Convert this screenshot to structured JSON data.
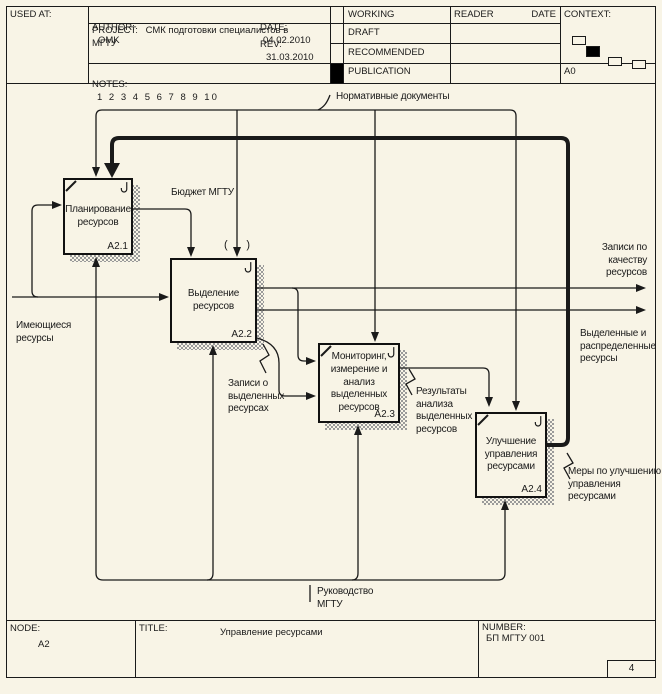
{
  "header": {
    "used_at": "USED AT:",
    "author_label": "AUTHOR:",
    "author_value": "OMK",
    "project_label": "PROJECT:",
    "project_value": "СМК подготовки специалистов в МГТУ",
    "notes_label": "NOTES:",
    "notes_value": "1 2 3 4 5 6 7 8 9 10",
    "date_label": "DATE:",
    "date_value": "04.02.2010",
    "rev_label": "REV:",
    "rev_value": "31.03.2010",
    "status_working": "WORKING",
    "status_draft": "DRAFT",
    "status_recommended": "RECOMMENDED",
    "status_publication": "PUBLICATION",
    "reader": "READER",
    "reader_date": "DATE",
    "context_label": "CONTEXT:",
    "context_node": "A0"
  },
  "diagram": {
    "boxes": [
      {
        "id": "A2.1",
        "label": "Планирование\nресурсов"
      },
      {
        "id": "A2.2",
        "label": "Выделение\nресурсов"
      },
      {
        "id": "A2.3",
        "label": "Мониторинг,\nизмерение и\nанализ\nвыделенных\nресурсов"
      },
      {
        "id": "A2.4",
        "label": "Улучшение\nуправления\nресурсами"
      }
    ],
    "arrows": {
      "normative_docs": "Нормативные документы",
      "budget": "Бюджет МГТУ",
      "available_resources": "Имеющиеся\nресурсы",
      "quality_records": "Записи по\nкачеству\nресурсов",
      "allocated_resources": "Выделенные и\nраспределенные\nресурсы",
      "allocation_records": "Записи о\nвыделенных\nресурсах",
      "analysis_results": "Результаты\nанализа\nвыделенных\nресурсов",
      "improvement_measures": "Меры по улучшению\nуправления\nресурсами",
      "management": "Руководство\nМГТУ",
      "tunnel_open": "(",
      "tunnel_close": ")"
    }
  },
  "footer": {
    "node_label": "NODE:",
    "node_value": "A2",
    "title_label": "TITLE:",
    "title_value": "Управление  ресурсами",
    "number_label": "NUMBER:",
    "number_value": "БП МГТУ 001",
    "page_number": "4"
  },
  "colors": {
    "background": "#f8f4e6",
    "line": "#1a1a1a",
    "shadow": "#9a9a9a"
  }
}
